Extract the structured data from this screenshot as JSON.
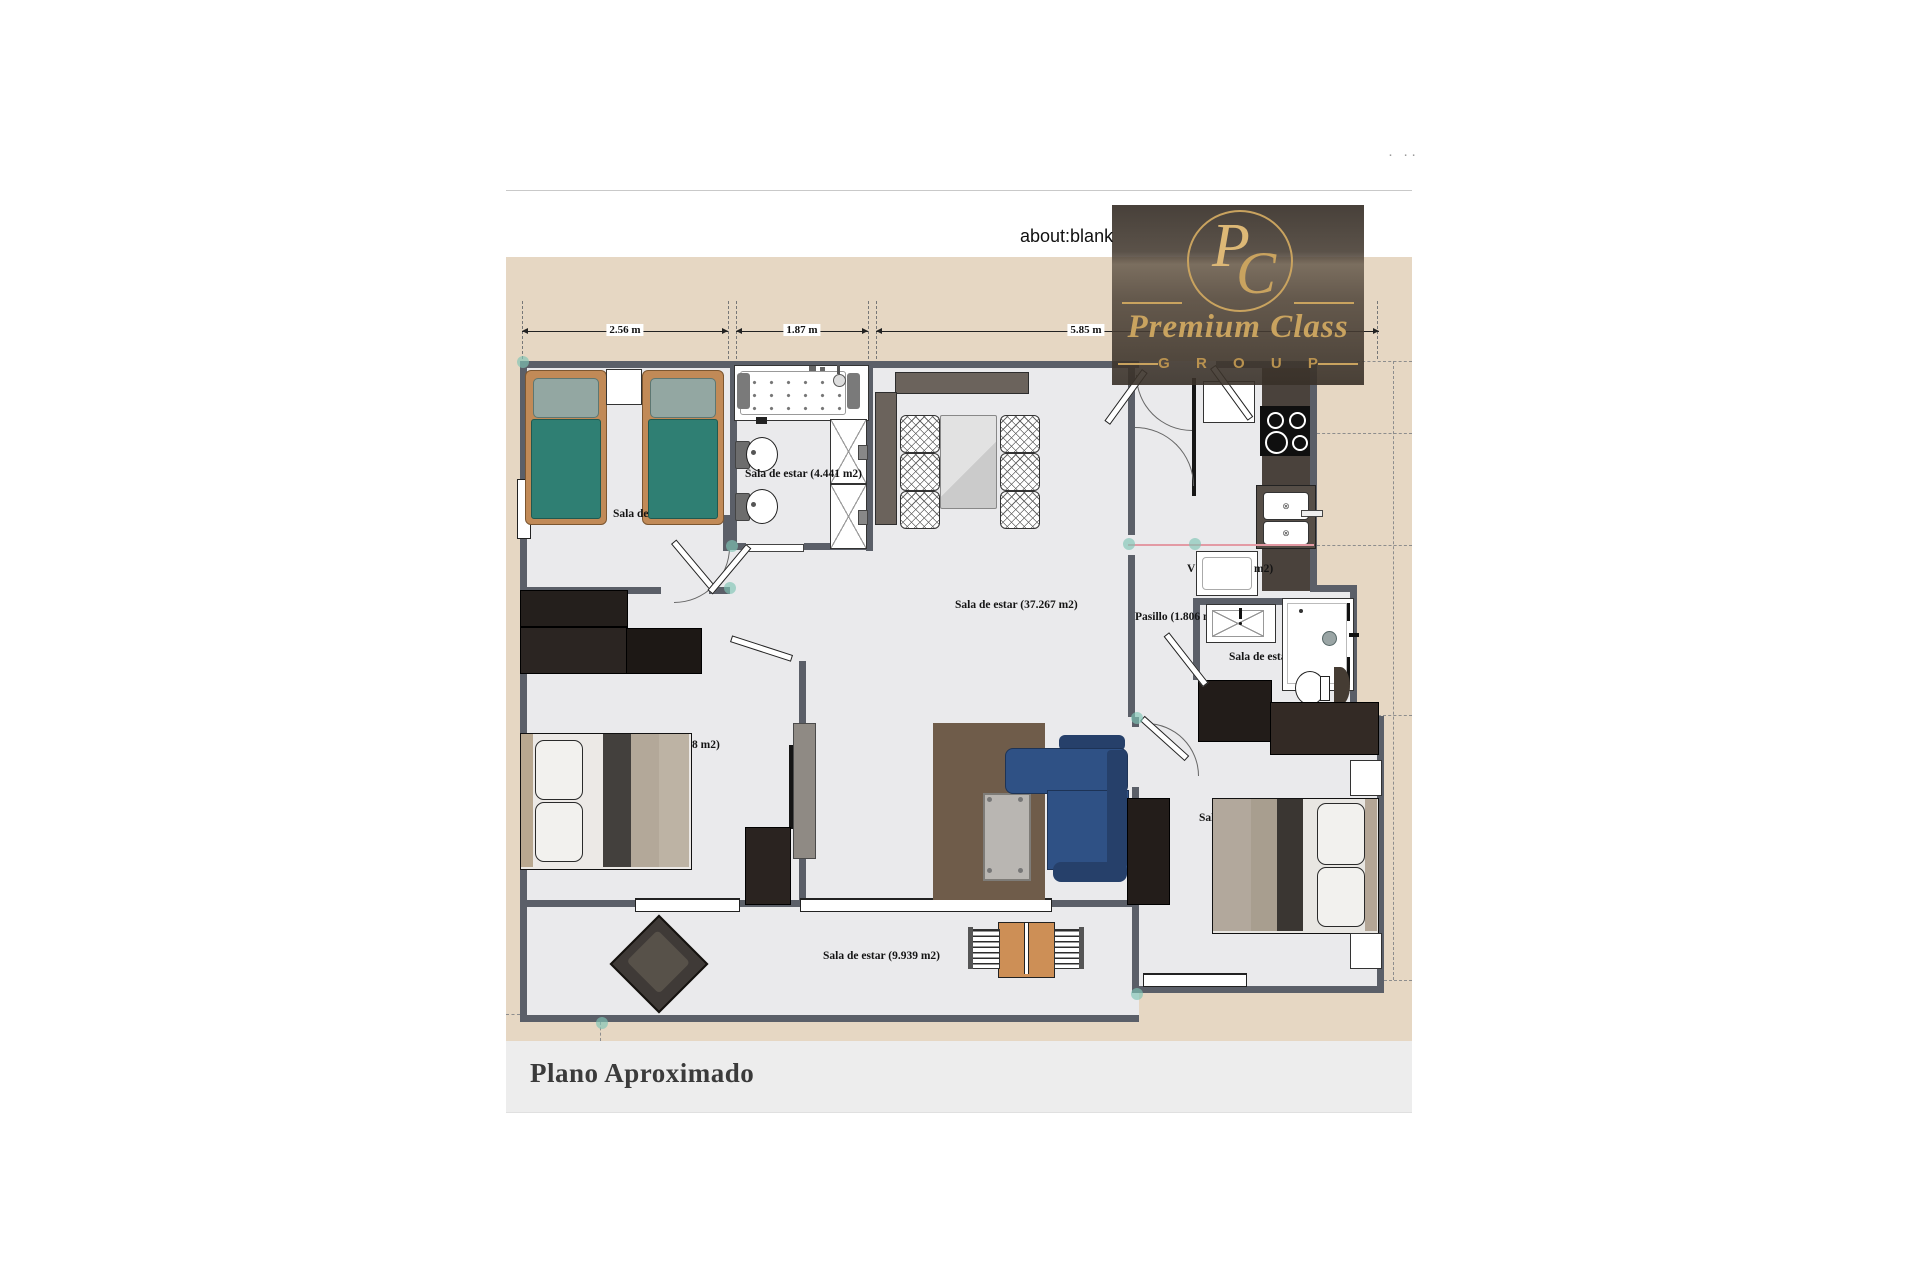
{
  "browser": {
    "url": "about:blank",
    "corner_dots": "· ··"
  },
  "logo": {
    "monogram_p": "P",
    "monogram_c": "C",
    "name": "Premium Class",
    "group": "G R O U P"
  },
  "plan": {
    "dimensions": {
      "d1": "2.56 m",
      "d2": "1.87 m",
      "d3": "5.85 m"
    },
    "labels": {
      "bedroom1_partial": "Sala de",
      "bath1": "Sala de estar (4.441 m2)",
      "living": "Sala de estar (37.267 m2)",
      "hallway_partial": "Pasillo (1.806 m",
      "utility_left": "V",
      "utility_right": "m2)",
      "bath2_partial": "Sala de estar (",
      "bedroom2_partial": "8 m2)",
      "bedroom3_partial": "Sal",
      "terrace": "Sala de estar (9.939 m2)"
    }
  },
  "footer": {
    "title": "Plano Aproximado"
  },
  "colors": {
    "tan": "#e6d7c3",
    "floor": "#eaeaec",
    "wall": "#5b5f68",
    "teal_bed": "#2f7f73",
    "bed_frame": "#c18a57",
    "pillow": "#93a7a2",
    "dark_furniture": "#241e1b",
    "dark_furniture2": "#322a26",
    "sofa_blue": "#2f5185",
    "sofa_blue_dark": "#26406a",
    "rug_brown": "#6f5c4a",
    "counter_brown": "#4a423c",
    "wood_orange": "#cd8f56",
    "gold": "#c9a35f",
    "gold_bright": "#ddb876",
    "accent_teal_dot": "rgba(128,196,182,0.65)",
    "pink_line": "#e39aa4",
    "footer_bg": "#ededed",
    "divider": "#c9c9c9",
    "text_dark": "#141414"
  }
}
